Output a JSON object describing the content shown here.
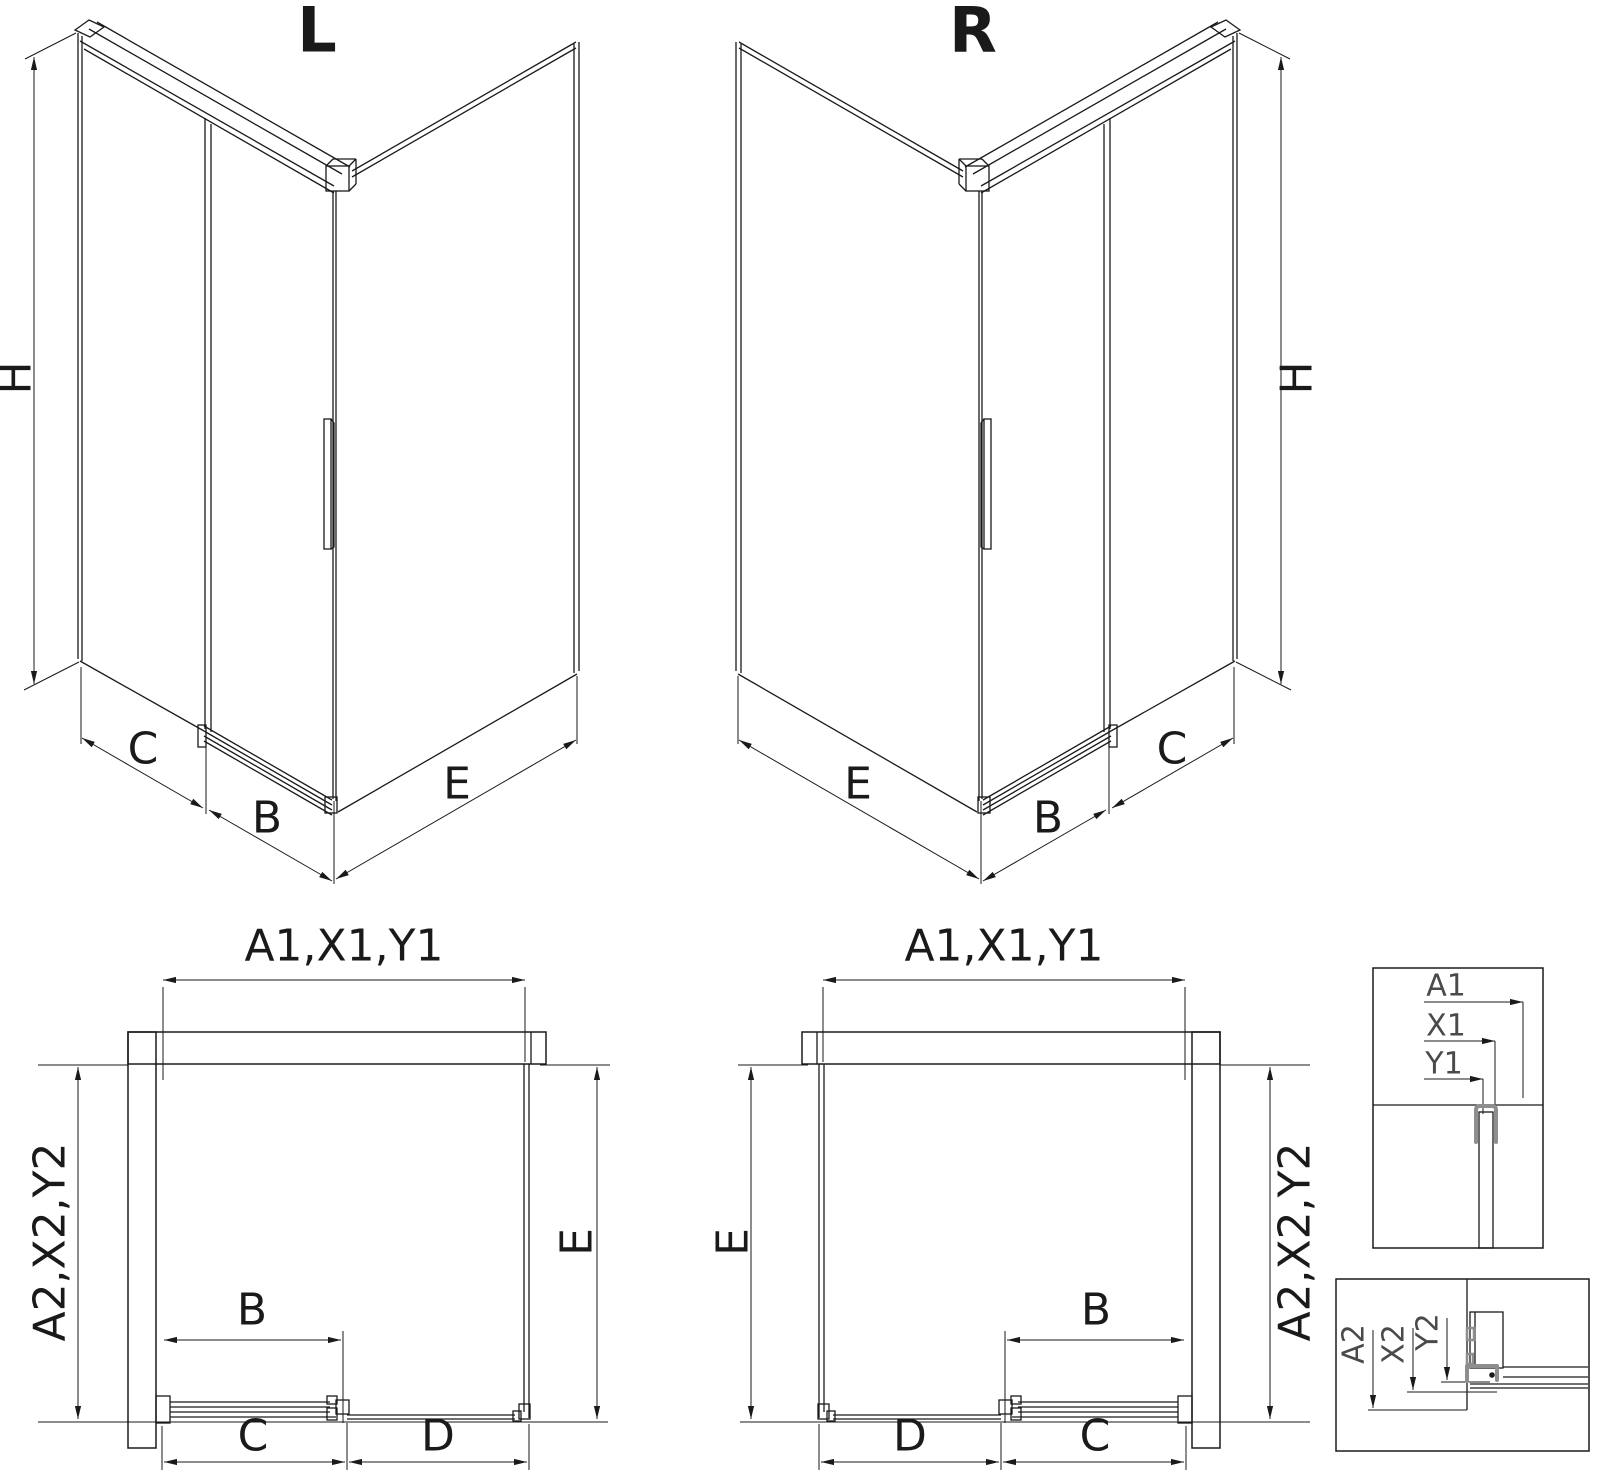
{
  "iso_left": {
    "title": "L",
    "dim_height": "H",
    "dim_back_panel": "C",
    "dim_door": "B",
    "dim_side_panel": "E"
  },
  "iso_right": {
    "title": "R",
    "dim_height": "H",
    "dim_back_panel": "C",
    "dim_door": "B",
    "dim_side_panel": "E"
  },
  "plan_left": {
    "dim_width": "A1,X1,Y1",
    "dim_depth": "A2,X2,Y2",
    "dim_door": "B",
    "dim_door_travel": "C",
    "dim_opening": "D",
    "dim_side": "E"
  },
  "plan_right": {
    "dim_width": "A1,X1,Y1",
    "dim_depth": "A2,X2,Y2",
    "dim_door": "B",
    "dim_door_travel": "C",
    "dim_opening": "D",
    "dim_side": "E"
  },
  "detail_width": {
    "dim_a": "A1",
    "dim_x": "X1",
    "dim_y": "Y1"
  },
  "detail_depth": {
    "dim_a": "A2",
    "dim_x": "X2",
    "dim_y": "Y2"
  },
  "colors": {
    "ink": "#1a1a1a",
    "profile_highlight": "#8e8e8e",
    "background": "#ffffff"
  }
}
